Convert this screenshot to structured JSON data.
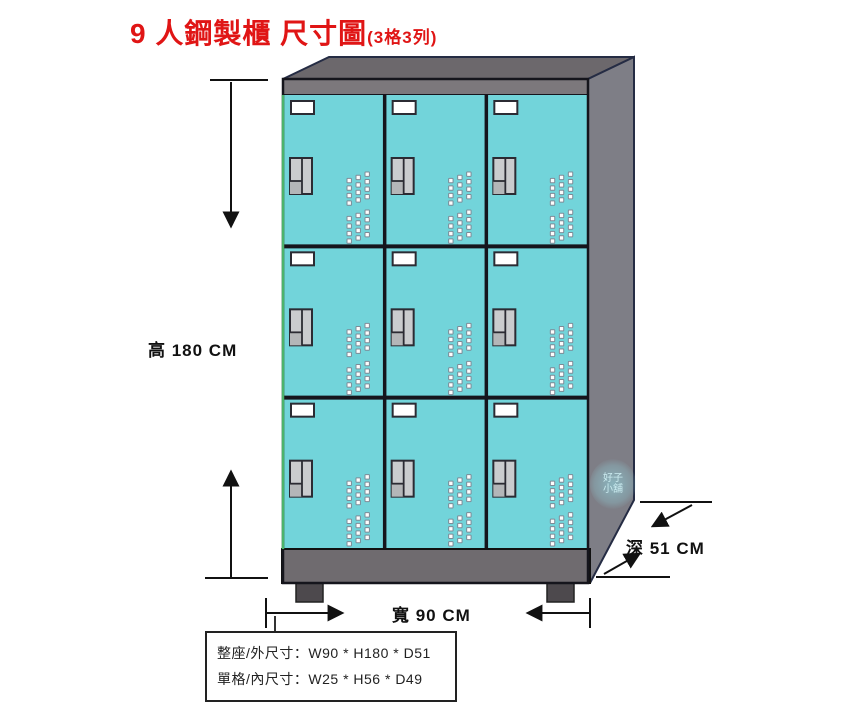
{
  "title": {
    "main": "9 人鋼製櫃 尺寸圖",
    "sub": "(3格3列)"
  },
  "dimensions": {
    "height_label": "高 180 CM",
    "width_label": "寬 90 CM",
    "depth_label": "深 51 CM"
  },
  "spec_box": {
    "line1": "整座/外尺寸：W90 * H180 * D51",
    "line2": "單格/內尺寸：W25 * H56 * D49"
  },
  "watermark": {
    "line1": "好子",
    "line2": "小舖"
  },
  "cabinet": {
    "rows": 3,
    "cols": 3,
    "door_count": 9
  },
  "colors": {
    "title_red": "#e01515",
    "door_teal": "#72d4da",
    "top_gray": "#6c686c",
    "band_gray": "#7c787c",
    "side_gray": "#7e7e86",
    "base_gray": "#6f6b6f",
    "foot_gray": "#4d494d",
    "frame_dark": "#15151c",
    "left_edge_green": "#4db36b",
    "outline_navy": "#252c44",
    "handle_gray": "#caccce",
    "handle_shadow": "#b4b6b8",
    "plate_white": "#ffffff"
  }
}
